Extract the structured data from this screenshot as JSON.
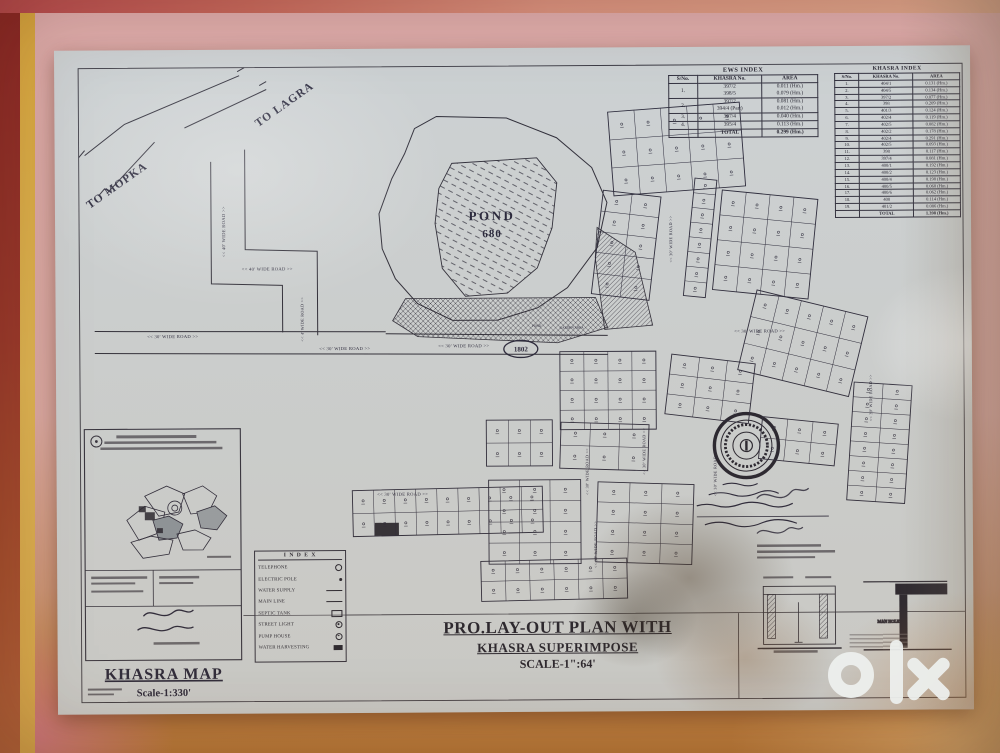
{
  "photo": {
    "watermark": "olx"
  },
  "plan": {
    "title_block": {
      "line1": "PRO.LAY-OUT  PLAN WITH",
      "line2": "KHASRA SUPERIMPOSE",
      "line3": "SCALE-1\":64'"
    },
    "labels": {
      "to_lagra": "TO LAGRA",
      "to_mopka": "TO MOPKA",
      "pond_name": "POND",
      "pond_number": "680",
      "pond_small": "POND",
      "garden_small": "GARDEN AREA",
      "oval_stamp": "1802",
      "man_hole": "MAN HOLE"
    },
    "road_labels": [
      {
        "t": "<< 40' WIDE ROAD >>",
        "x": 170,
        "y": 182,
        "r": -90,
        "s": 4.6
      },
      {
        "t": "<< 40' WIDE ROAD >>",
        "x": 212,
        "y": 221,
        "r": 0,
        "s": 4.6
      },
      {
        "t": "<< 4' WIDE ROAD >>",
        "x": 248,
        "y": 270,
        "r": -90,
        "s": 4.2
      },
      {
        "t": "<< 30' WIDE ROAD >>",
        "x": 117,
        "y": 288,
        "r": 0,
        "s": 4.6
      },
      {
        "t": "<< 30' WIDE ROAD >>",
        "x": 289,
        "y": 301,
        "r": 0,
        "s": 4.6
      },
      {
        "t": "<< 30' WIDE ROAD >>",
        "x": 408,
        "y": 299,
        "r": 0,
        "s": 4.6
      },
      {
        "t": "<< 30' WIDE ROAD >>",
        "x": 704,
        "y": 286,
        "r": 0,
        "s": 4.6
      },
      {
        "t": "<< 30' WIDE ROAD >>",
        "x": 617,
        "y": 192,
        "r": -90,
        "s": 4.2
      },
      {
        "t": "<< 30' WIDE ROAD >>",
        "x": 532,
        "y": 424,
        "r": -90,
        "s": 4.2
      },
      {
        "t": "<< 30' WIDE ROAD >>",
        "x": 589,
        "y": 404,
        "r": -90,
        "s": 4.2
      },
      {
        "t": "<< 30' WIDE ROAD >>",
        "x": 346,
        "y": 447,
        "r": 0,
        "s": 4.6
      },
      {
        "t": "<< 30' WIDE ROAD >>",
        "x": 816,
        "y": 352,
        "r": -90,
        "s": 4.2
      },
      {
        "t": "<< 30' WIDE ROAD >>",
        "x": 540,
        "y": 497,
        "r": -90,
        "s": 4.2
      },
      {
        "t": "<< 30' WIDE ROAD >>",
        "x": 660,
        "y": 426,
        "r": -90,
        "s": 4.2
      }
    ],
    "blocks": [
      [
        542,
        146,
        58,
        104,
        5,
        2,
        7
      ],
      [
        556,
        60,
        132,
        84,
        3,
        5,
        -4
      ],
      [
        634,
        132,
        22,
        118,
        8,
        1,
        6
      ],
      [
        662,
        148,
        96,
        100,
        4,
        4,
        6
      ],
      [
        690,
        256,
        114,
        82,
        3,
        5,
        14
      ],
      [
        794,
        338,
        58,
        118,
        8,
        2,
        4
      ],
      [
        504,
        304,
        96,
        78,
        4,
        4,
        0
      ],
      [
        612,
        312,
        84,
        60,
        3,
        3,
        7
      ],
      [
        296,
        440,
        190,
        46,
        2,
        9,
        -1
      ],
      [
        430,
        372,
        66,
        46,
        2,
        3,
        0
      ],
      [
        504,
        376,
        88,
        46,
        2,
        3,
        2
      ],
      [
        432,
        432,
        92,
        84,
        4,
        3,
        0
      ],
      [
        540,
        436,
        96,
        80,
        4,
        3,
        2
      ],
      [
        424,
        512,
        146,
        40,
        2,
        6,
        -1
      ],
      [
        704,
        374,
        76,
        42,
        2,
        3,
        6
      ]
    ]
  },
  "ews_index": {
    "title": "EWS INDEX",
    "columns": [
      "S/No.",
      "KHASRA No.",
      "AREA"
    ],
    "rows": [
      [
        "1.",
        "397/2\n398/5",
        "0.011 (Hm.)\n0.079 (Hm.)"
      ],
      [
        "2.",
        "397/2\n394/4 (Part)",
        "0.081 (Hm.)\n0.012 (Hm.)"
      ],
      [
        "3.",
        "397/4",
        "0.040 (Hm.)"
      ],
      [
        "4.",
        "395/4",
        "0.113 (Hm.)"
      ]
    ],
    "total_label": "TOTAL",
    "total_value": "0.299 (Hm.)"
  },
  "khasra_index": {
    "title": "KHASRA INDEX",
    "columns": [
      "S/No.",
      "KHASRA No.",
      "AREA"
    ],
    "rows": [
      [
        "1.",
        "404/1",
        "0.131 (Hm.)"
      ],
      [
        "2.",
        "404/5",
        "0.134 (Hm.)"
      ],
      [
        "3.",
        "397/2",
        "0.077 (Hm.)"
      ],
      [
        "4.",
        "398",
        "0.209 (Hm.)"
      ],
      [
        "5.",
        "401/3",
        "0.124 (Hm.)"
      ],
      [
        "6.",
        "402/4",
        "0.119 (Hm.)"
      ],
      [
        "7.",
        "402/5",
        "0.082 (Hm.)"
      ],
      [
        "8.",
        "402/2",
        "0.178 (Hm.)"
      ],
      [
        "9.",
        "402/4",
        "0.291 (Hm.)"
      ],
      [
        "10.",
        "402/5",
        "0.093 (Hm.)"
      ],
      [
        "11.",
        "398",
        "0.117 (Hm.)"
      ],
      [
        "12.",
        "397/4",
        "0.081 (Hm.)"
      ],
      [
        "13.",
        "400/1",
        "0.192 (Hm.)"
      ],
      [
        "14.",
        "400/2",
        "0.123 (Hm.)"
      ],
      [
        "15.",
        "400/4",
        "0.198 (Hm.)"
      ],
      [
        "16.",
        "400/5",
        "0.068 (Hm.)"
      ],
      [
        "17.",
        "400/6",
        "0.062 (Hm.)"
      ],
      [
        "18.",
        "400",
        "0.114 (Hm.)"
      ],
      [
        "19.",
        "401/2",
        "0.086 (Hm.)"
      ]
    ],
    "total_label": "TOTAL",
    "total_value": "1.398 (Hm.)"
  },
  "legend": {
    "title": "I N D E X",
    "items": [
      {
        "label": "TELEPHONE",
        "sym": "circle"
      },
      {
        "label": "ELECTRIC POLE",
        "sym": "dot"
      },
      {
        "label": "WATER SUPPLY",
        "sym": "line"
      },
      {
        "label": "MAIN LINE",
        "sym": "line"
      },
      {
        "label": "SEPTIC TANK",
        "sym": "box"
      },
      {
        "label": "STREET LIGHT",
        "sym": "circdot"
      },
      {
        "label": "PUMP HOUSE",
        "sym": "circdot"
      },
      {
        "label": "WATER HARVESTING",
        "sym": "boxfill"
      }
    ]
  },
  "inset": {
    "title": "KHASRA MAP",
    "scale": "Scale-1:330'"
  }
}
